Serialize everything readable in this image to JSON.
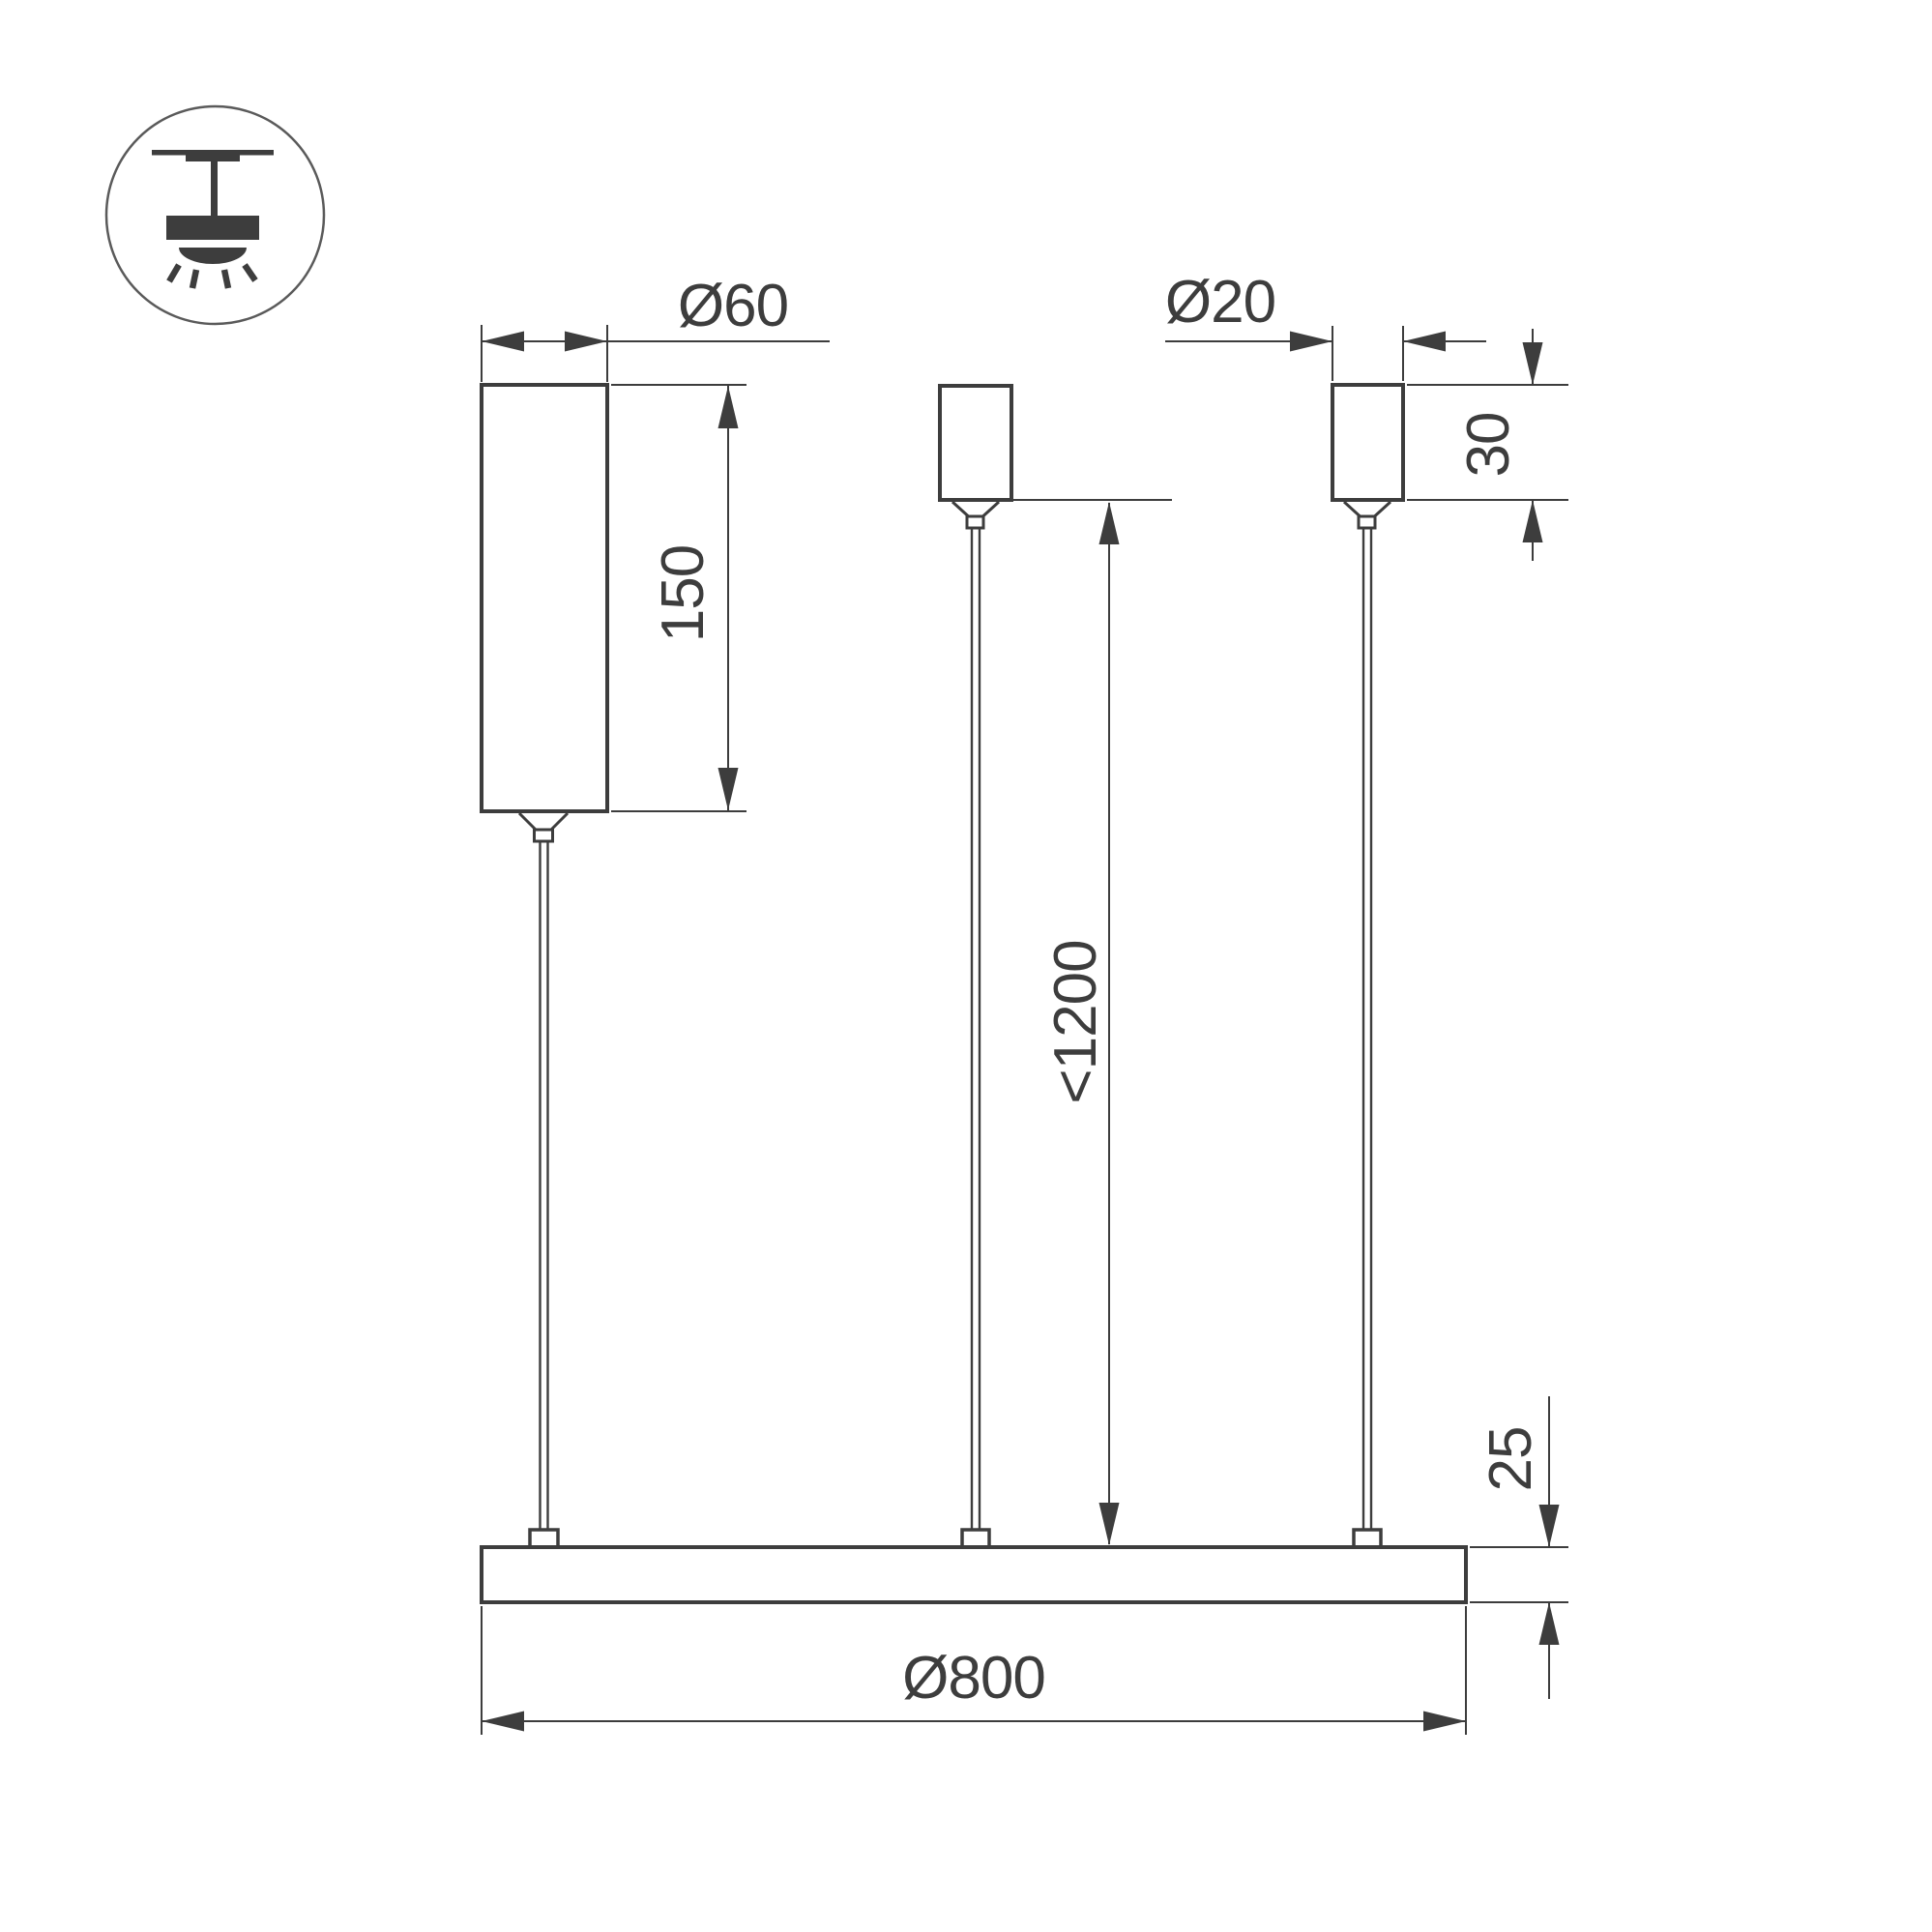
{
  "colors": {
    "line": "#3d3d3d",
    "background": "#ffffff"
  },
  "icon": {
    "type": "ceiling-pendant-luminaire-icon"
  },
  "dimensions": {
    "driver_diameter": {
      "label": "Ø60",
      "value": 60
    },
    "driver_height": {
      "label": "150",
      "value": 150
    },
    "canopy_diameter": {
      "label": "Ø20",
      "value": 20
    },
    "canopy_height": {
      "label": "30",
      "value": 30
    },
    "suspension_length": {
      "label": "<1200",
      "value": 1200
    },
    "bar_thickness": {
      "label": "25",
      "value": 25
    },
    "bar_diameter": {
      "label": "Ø800",
      "value": 800
    }
  }
}
